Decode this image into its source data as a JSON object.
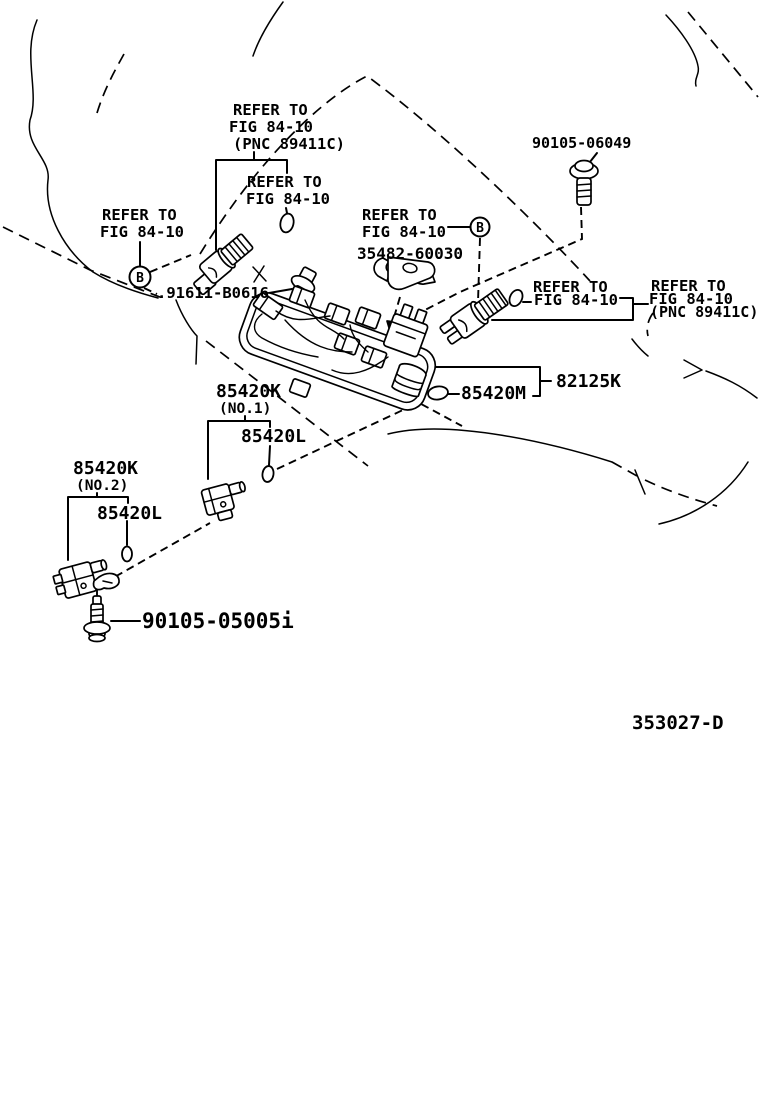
{
  "figure": {
    "code": "353027-D"
  },
  "refer": {
    "to": "REFER TO",
    "fig": "FIG 84-10",
    "pnc": "(PNC 89411C)"
  },
  "callout": {
    "b": "B"
  },
  "parts": {
    "bolt_top": "90105-06049",
    "clamp": "35482-60030",
    "union_bolt": ".91611-B0616",
    "junction_block": "82125K",
    "oring_m": "85420M",
    "sensor_k": "85420K",
    "no1": "(NO.1)",
    "no2": "(NO.2)",
    "oring_l": "85420L",
    "bolt_bottom": "90105-05005i"
  }
}
